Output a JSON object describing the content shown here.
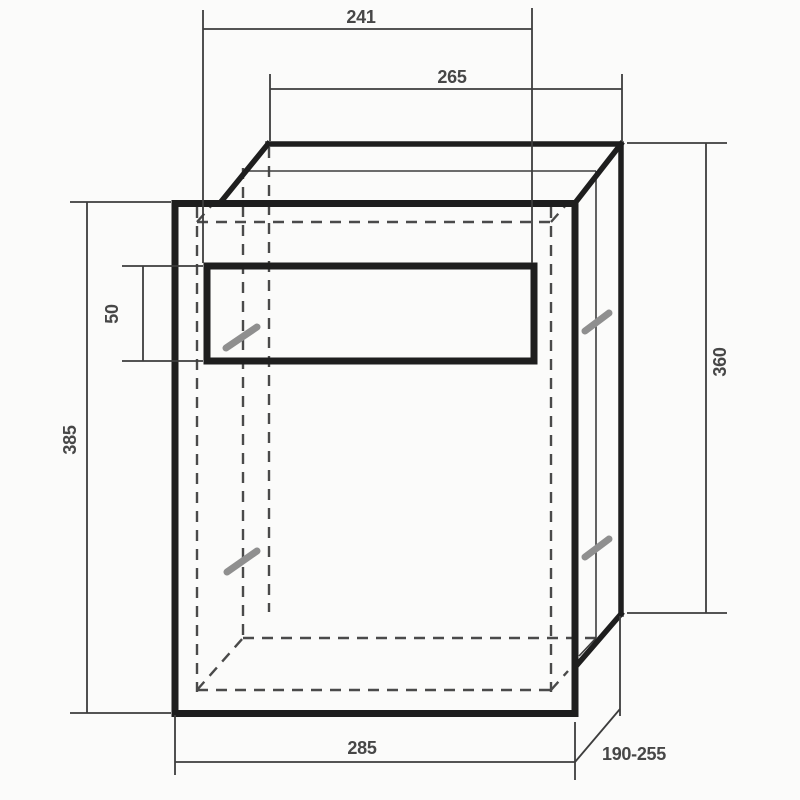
{
  "drawing": {
    "title": "Recessed letterbox dimension drawing",
    "view": "front panel with mail slot, box body in oblique projection, hidden cavity dashed",
    "background": "#fbfbfa",
    "palette": {
      "outline": "#1e1e1e",
      "dimension_line": "#3d3d3d",
      "hidden_line": "#4a4a4a",
      "hatch_mark": "#8f8f8f",
      "label_text": "#474747"
    },
    "dimensions": {
      "slot_width": "241",
      "body_width": "265",
      "slot_height": "50",
      "panel_height": "385",
      "body_height": "360",
      "panel_width": "285",
      "body_depth": "190-255"
    }
  }
}
